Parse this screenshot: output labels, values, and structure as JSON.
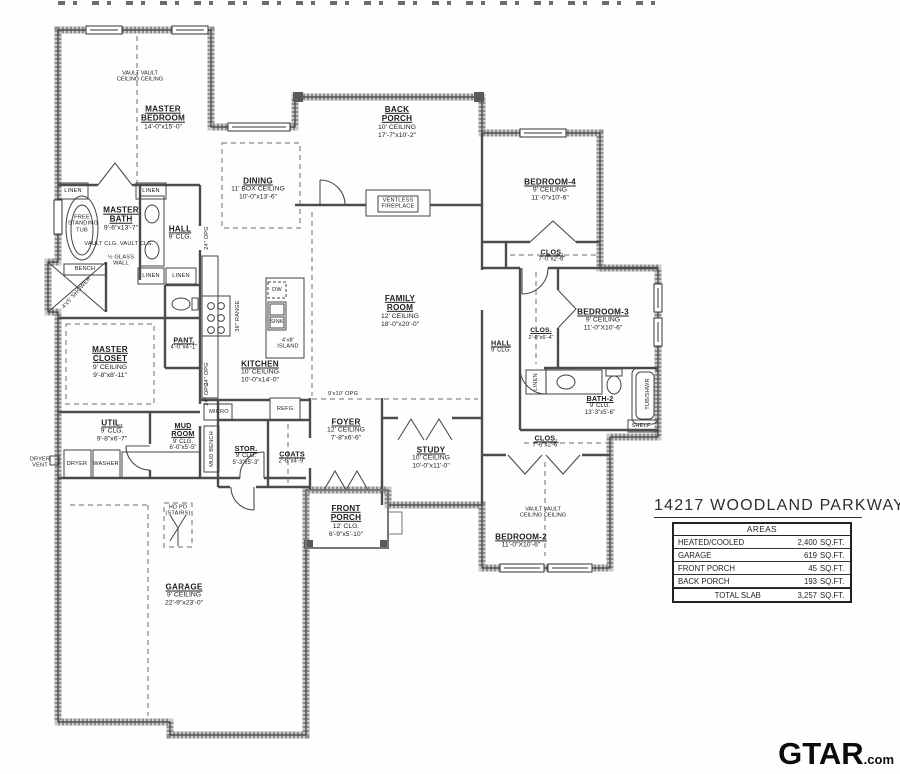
{
  "title": "14217 WOODLAND PARKWAY",
  "areas_table": {
    "header": "AREAS",
    "rows": [
      {
        "label": "HEATED/COOLED",
        "value": "2,400",
        "unit": "SQ.FT."
      },
      {
        "label": "GARAGE",
        "value": "619",
        "unit": "SQ.FT."
      },
      {
        "label": "FRONT PORCH",
        "value": "45",
        "unit": "SQ.FT."
      },
      {
        "label": "BACK PORCH",
        "value": "193",
        "unit": "SQ.FT."
      }
    ],
    "total": {
      "label": "TOTAL SLAB",
      "value": "3,257",
      "unit": "SQ.FT."
    }
  },
  "watermark": {
    "brand": "GTAR",
    "suffix": ".com"
  },
  "rooms": {
    "master_bedroom": {
      "name": "MASTER BEDROOM",
      "dims": "14'-0\"x15'-0\"",
      "vault1": "VAULT  VAULT",
      "vault2": "CEILING CEILING"
    },
    "back_porch": {
      "name": "BACK PORCH",
      "ceiling": "10' CEILING",
      "dims": "17'-7\"x10'-2\""
    },
    "bedroom4": {
      "name": "BEDROOM-4",
      "ceiling": "9' CEILING",
      "dims": "11'-0\"x10'-6\""
    },
    "clos_bed4": {
      "name": "CLOS.",
      "dims": "7'-0\"x2'-6\""
    },
    "dining": {
      "name": "DINING",
      "ceiling": "11' BOX CEILING",
      "dims": "10'-0\"x13'-6\""
    },
    "master_bath": {
      "name": "MASTER BATH",
      "dims": "9'-6\"x13'-7\"",
      "vault": "VAULT CLG.  VAULT CLG."
    },
    "hall_left": {
      "name": "HALL",
      "ceiling": "9' CLG."
    },
    "family_room": {
      "name": "FAMILY ROOM",
      "ceiling": "12' CEILING",
      "dims": "18'-0\"x20'-0\""
    },
    "kitchen": {
      "name": "KITCHEN",
      "ceiling": "10' CEILING",
      "dims": "10'-0\"x14'-0\""
    },
    "master_closet": {
      "name": "MASTER CLOSET",
      "ceiling": "9' CEILING",
      "dims": "9'-8\"x8'-11\""
    },
    "pantry": {
      "name": "PANT.",
      "dims": "4'-0\"x4'-1\""
    },
    "bedroom3": {
      "name": "BEDROOM-3",
      "ceiling": "9' CEILING",
      "dims": "11'-0\"X10'-6\""
    },
    "clos_bed3": {
      "name": "CLOS.",
      "dims": "2'-0\"x6'-4\""
    },
    "hall_right": {
      "name": "HALL",
      "ceiling": "9' CLG."
    },
    "bath2": {
      "name": "BATH-2",
      "ceiling": "9' CLG.",
      "dims": "13'-3\"x5'-6\""
    },
    "util": {
      "name": "UTIL.",
      "ceiling": "9' CLG.",
      "dims": "9'-8\"x6'-7\""
    },
    "mud_room": {
      "name": "MUD ROOM",
      "ceiling": "9' CLG.",
      "dims": "6'-0\"x5'-5\""
    },
    "stor": {
      "name": "STOR.",
      "ceiling": "9' CLG.",
      "dims": "5'-3\"x5'-3\""
    },
    "coats": {
      "name": "COATS",
      "dims": "2'-6\"x4'-9\""
    },
    "foyer": {
      "name": "FOYER",
      "ceiling": "12' CEILING",
      "dims": "7'-8\"x6'-6\""
    },
    "study": {
      "name": "STUDY",
      "ceiling": "10' CEILING",
      "dims": "10'-0\"x11'-0\""
    },
    "front_porch": {
      "name": "FRONT PORCH",
      "ceiling": "12' CLG.",
      "dims": "6'-9\"x5'-10\""
    },
    "bedroom2": {
      "name": "BEDROOM-2",
      "dims": "11'-0\"X10'-6\"",
      "vault1": "VAULT  VAULT",
      "vault2": "CEILING CEILING"
    },
    "clos_bed2": {
      "name": "CLOS.",
      "dims": "7'-6\"x2'-6\""
    },
    "garage": {
      "name": "GARAGE",
      "ceiling": "9' CEILING",
      "dims": "22'-9\"x23'-0\""
    }
  },
  "fixtures": {
    "ventless_fireplace": "VENTLESS FIREPLACE",
    "free_standing_tub": "FREE STANDING TUB",
    "glass_wall": "½ GLASS WALL",
    "bench": "BENCH",
    "shower": "4'x5' SHOWER",
    "linen": "LINEN",
    "dw": "DW",
    "sink": "SINK",
    "island": "4'x8' ISLAND",
    "range": "36\" RANGE",
    "refg": "REFG.",
    "micro": "MICRO",
    "mud_bench": "MUD BENCH",
    "dryer": "DRYER",
    "washer": "WASHER",
    "dryer_vent": "DRYER VENT",
    "tub_shwr": "TUB/SHWR",
    "shelf": "SHELF",
    "stairs": "HD PD (STAIRS)",
    "opening_24": "24\" OPG",
    "opening_9x10": "9'x10' OPG"
  }
}
